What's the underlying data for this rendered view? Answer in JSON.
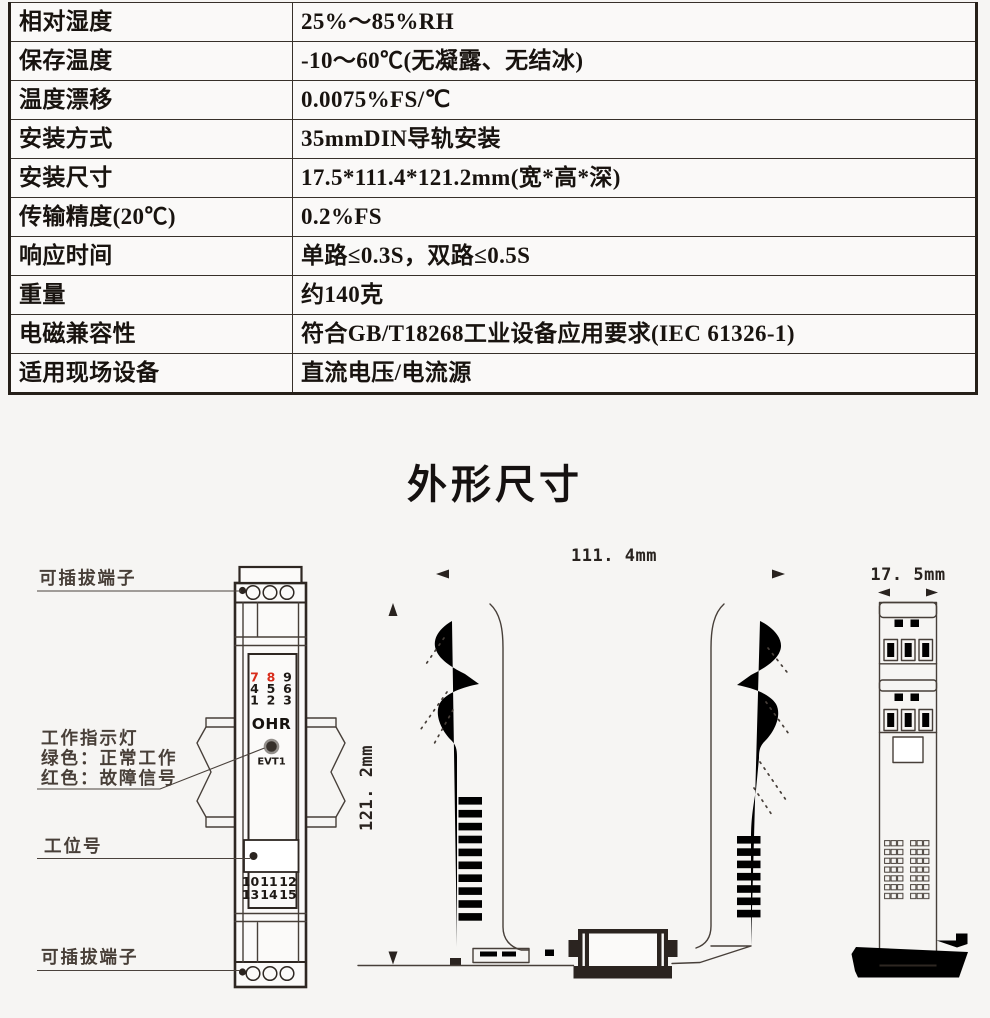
{
  "page": {
    "background": "#f6f5f3"
  },
  "spec_table": {
    "rows": [
      {
        "label": "相对湿度",
        "value": "25%～85%RH"
      },
      {
        "label": "保存温度",
        "value": "-10～60℃(无凝露、无结冰)"
      },
      {
        "label": "温度漂移",
        "value": "0.0075%FS/℃"
      },
      {
        "label": "安装方式",
        "value": "35mmDIN导轨安装"
      },
      {
        "label": "安装尺寸",
        "value": "17.5*111.4*121.2mm(宽*高*深)"
      },
      {
        "label": "传输精度(20℃)",
        "value": "0.2%FS"
      },
      {
        "label": "响应时间",
        "value": "单路≤0.3S，双路≤0.5S"
      },
      {
        "label": "重量",
        "value": "约140克"
      },
      {
        "label": "电磁兼容性",
        "value": "符合GB/T18268工业设备应用要求(IEC 61326-1)"
      },
      {
        "label": "适用现场设备",
        "value": "直流电压/电流源"
      }
    ]
  },
  "section_title": "外形尺寸",
  "drawing": {
    "labels": {
      "terminal_top": "可插拔端子",
      "indicator_title": "工作指示灯",
      "indicator_green": "绿色：正常工作",
      "indicator_red": "红色：故障信号",
      "station": "工位号",
      "terminal_bottom": "可插拔端子"
    },
    "front": {
      "brand": "OHR",
      "led_label": "EVT1",
      "top_terminals": [
        "7",
        "8",
        "9",
        "4",
        "5",
        "6",
        "1",
        "2",
        "3"
      ],
      "bottom_terminals": [
        "10",
        "11",
        "12",
        "13",
        "14",
        "15"
      ]
    },
    "dims": {
      "width": "111. 4mm",
      "height": "121. 2mm",
      "depth": "17. 5mm"
    },
    "colors": {
      "red_terminal": "#d92c1b",
      "line": "#473f39"
    }
  }
}
